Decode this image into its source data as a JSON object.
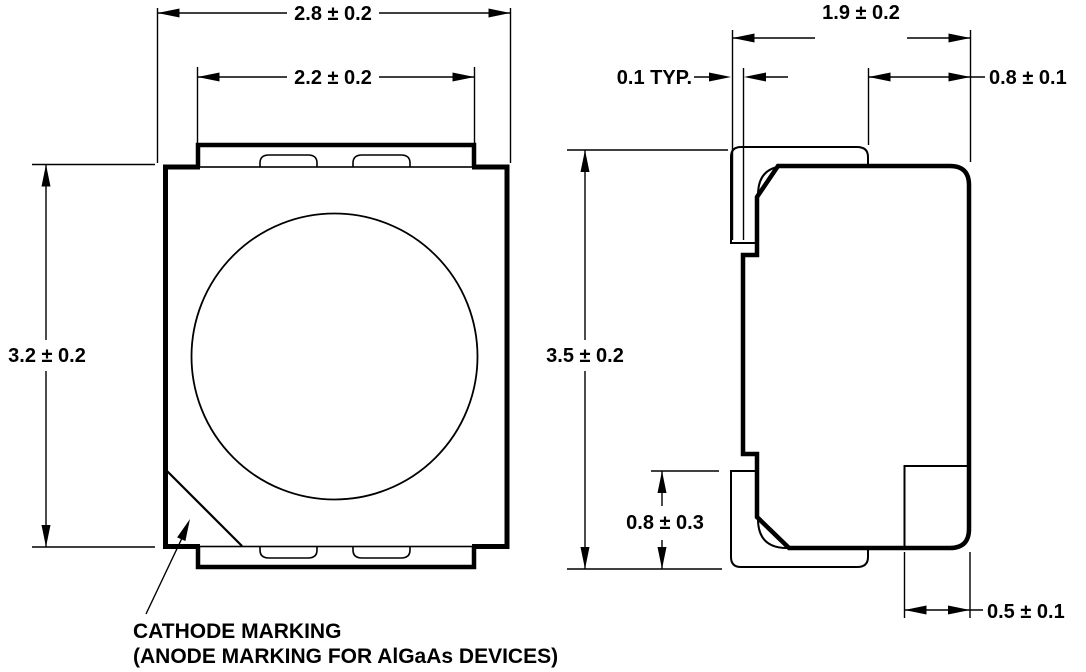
{
  "drawing": {
    "type": "package-outline-drawing",
    "units_implied": "mm",
    "colors": {
      "line": "#000000",
      "background": "#ffffff"
    },
    "top_view": {
      "dim_overall_width": "2.8 ± 0.2",
      "dim_inner_width": "2.2 ± 0.2",
      "dim_overall_height": "3.2 ± 0.2",
      "note_line1": "CATHODE MARKING",
      "note_line2": "(ANODE MARKING FOR AlGaAs DEVICES)"
    },
    "side_view": {
      "dim_overall_depth": "1.9 ± 0.2",
      "dim_lead_standoff": "0.1 TYP.",
      "dim_top_lead_length": "0.8 ± 0.1",
      "dim_overall_height": "3.5 ± 0.2",
      "dim_lead_height": "0.8 ± 0.3",
      "dim_bottom_terminal": "0.5 ± 0.1"
    }
  }
}
